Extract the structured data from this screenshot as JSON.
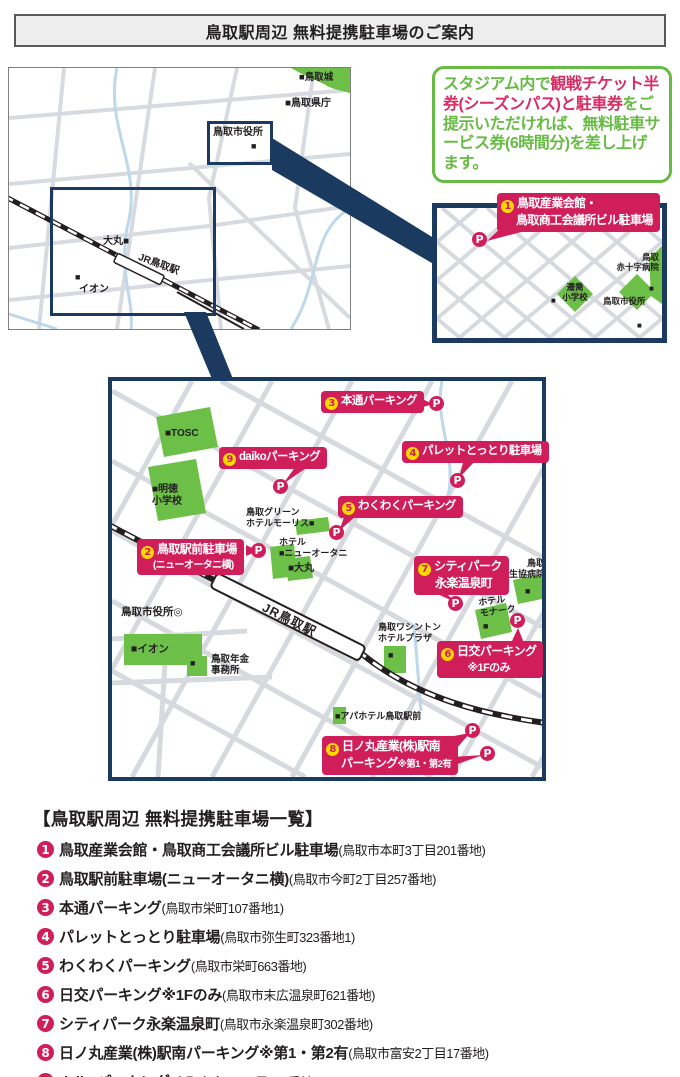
{
  "title": "鳥取駅周辺 無料提携駐車場のご案内",
  "info_box": {
    "green1": "スタジアム内で",
    "pink": "観戦チケット半券(シーズンパス)と駐車券",
    "green2": "をご提示いただければ、無料駐車サービス券(6時間分)を差し上げます。"
  },
  "overview_map": {
    "castle": "■鳥取城",
    "prefecture": "■鳥取県庁",
    "city_hall": "鳥取市役所",
    "city_hall_sq": "■",
    "daimaru": "大丸■",
    "jr_station": "JR鳥取駅",
    "aeon_sq": "■",
    "aeon": "イオン"
  },
  "inset_map": {
    "school": "遷喬\n小学校",
    "school_sq": "■",
    "city_hall": "鳥取市役所",
    "city_hall_sq": "■",
    "red_cross": "鳥取\n赤十字病院",
    "red_cross_sq": "■"
  },
  "main_map": {
    "tosc": "■TOSC",
    "meitoku": "■明徳\n小学校",
    "green_hotel": "鳥取グリーン\nホテルモーリス■",
    "new_otani": "ホテル\n■ニューオータニ",
    "daimaru": "■大丸",
    "aeon": "■イオン",
    "pension_sq": "■",
    "pension": "鳥取年金\n事務所",
    "city_hall": "鳥取市役所◎",
    "jr_station": "JR鳥取駅",
    "apa": "■アパホテル鳥取駅前",
    "washington_sq": "■",
    "washington": "鳥取ワシントン\nホテルプラザ",
    "monarch": "ホテル\nモナーク",
    "monarch_sq": "■",
    "coop": "鳥取\n生協病院",
    "coop_sq": "■"
  },
  "callouts": {
    "p": "P",
    "c1": {
      "num": "1",
      "line1": "鳥取産業会館・",
      "line2": "鳥取商工会議所ビル駐車場"
    },
    "c2": {
      "num": "2",
      "line1": "鳥取駅前駐車場",
      "line2": "(ニューオータニ横)"
    },
    "c3": {
      "num": "3",
      "label": "本通パーキング"
    },
    "c4": {
      "num": "4",
      "label": "パレットとっとり駐車場"
    },
    "c5": {
      "num": "5",
      "label": "わくわくパーキング"
    },
    "c6": {
      "num": "6",
      "line1": "日交パーキング",
      "line2": "※1Fのみ"
    },
    "c7": {
      "num": "7",
      "line1": "シティパーク",
      "line2": "永楽温泉町"
    },
    "c8": {
      "num": "8",
      "line1": "日ノ丸産業(株)駅南",
      "line2a": "パーキング",
      "line2b": "※第1・第2有"
    },
    "c9": {
      "num": "9",
      "label": "daikoパーキング"
    }
  },
  "list": {
    "heading": "【鳥取駅周辺 無料提携駐車場一覧】",
    "items": [
      {
        "num": "1",
        "name": "鳥取産業会館・鳥取商工会議所ビル駐車場",
        "address": "(鳥取市本町3丁目201番地)"
      },
      {
        "num": "2",
        "name": "鳥取駅前駐車場(ニューオータニ横)",
        "address": "(鳥取市今町2丁目257番地)"
      },
      {
        "num": "3",
        "name": "本通パーキング",
        "address": "(鳥取市栄町107番地1)"
      },
      {
        "num": "4",
        "name": "パレットとっとり駐車場",
        "address": "(鳥取市弥生町323番地1)"
      },
      {
        "num": "5",
        "name": "わくわくパーキング",
        "address": "(鳥取市栄町663番地)"
      },
      {
        "num": "6",
        "name": "日交パーキング※1Fのみ",
        "address": "(鳥取市末広温泉町621番地)"
      },
      {
        "num": "7",
        "name": "シティパーク永楽温泉町",
        "address": "(鳥取市永楽温泉町302番地)"
      },
      {
        "num": "8",
        "name": "日ノ丸産業(株)駅南パーキング※第1・第2有",
        "address": "(鳥取市富安2丁目17番地)"
      },
      {
        "num": "9",
        "name": "daikoパーキング",
        "address": "(鳥取市今町1丁目124番地)"
      }
    ]
  },
  "colors": {
    "accent_pink": "#d01e5a",
    "accent_yellow": "#ffd800",
    "map_green": "#6cbf47",
    "navy": "#1b3a60",
    "text_green": "#67bb45",
    "road_gray": "#d7dbe0",
    "road_blue": "#bcd8ea"
  }
}
